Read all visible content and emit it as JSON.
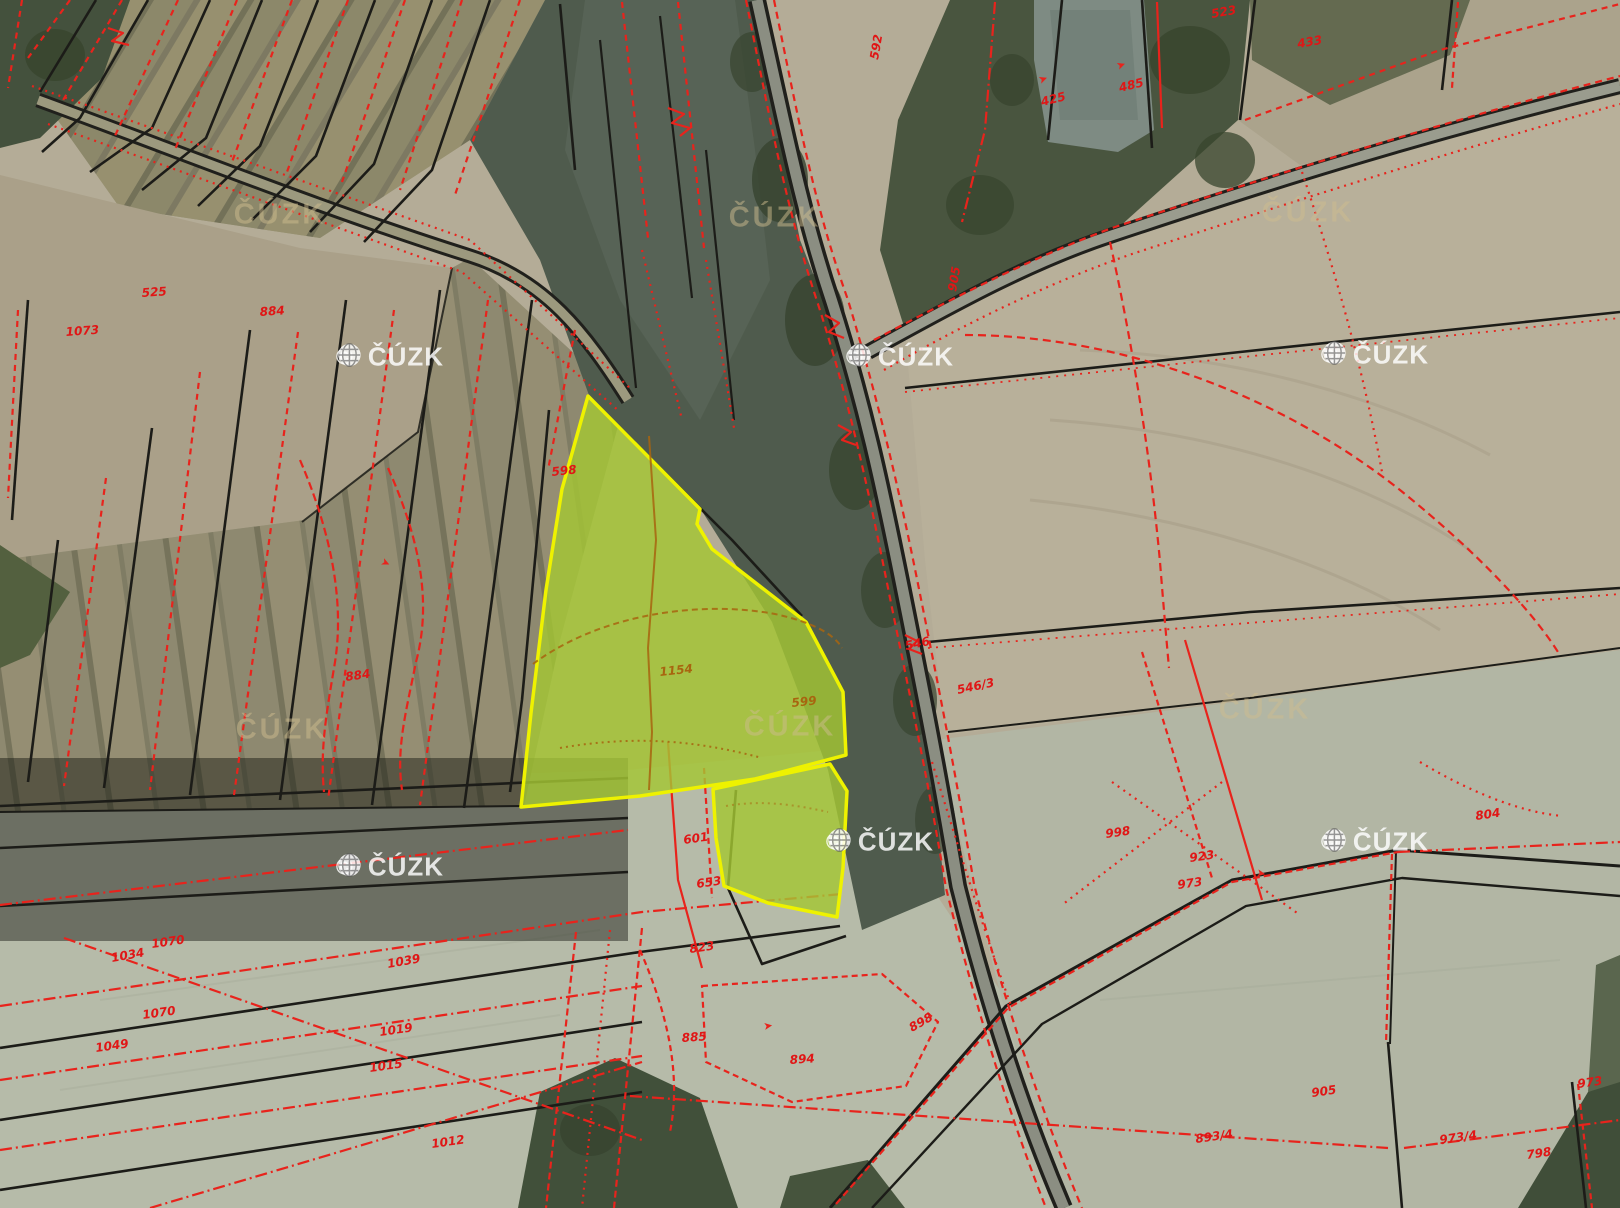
{
  "watermarks": {
    "copyright_symbol": "©",
    "brand": "ČÚZK",
    "logo_items": [
      {
        "x": 390,
        "y": 357
      },
      {
        "x": 900,
        "y": 357
      },
      {
        "x": 1375,
        "y": 355
      },
      {
        "x": 390,
        "y": 867
      },
      {
        "x": 880,
        "y": 842
      },
      {
        "x": 1375,
        "y": 842
      }
    ],
    "text_items": [
      {
        "x": 280,
        "y": 215
      },
      {
        "x": 775,
        "y": 218
      },
      {
        "x": 1308,
        "y": 213
      },
      {
        "x": 282,
        "y": 730
      },
      {
        "x": 790,
        "y": 727
      },
      {
        "x": 1265,
        "y": 710
      }
    ]
  },
  "colors": {
    "cadastral_line_red": "#e8231c",
    "boundary_line_black": "#1c1c18",
    "highlight_fill": "#a4c633",
    "highlight_stroke": "#eef200",
    "label_red": "#e01616",
    "label_orange": "#a8650f",
    "watermark_white": "rgba(255,255,255,0.82)",
    "watermark_beige": "rgba(205,188,142,0.5)"
  },
  "parcel_labels": [
    {
      "t": "523",
      "x": 1212,
      "y": 18,
      "r": -10
    },
    {
      "t": "433",
      "x": 1298,
      "y": 48,
      "r": -10
    },
    {
      "t": "425",
      "x": 1042,
      "y": 106,
      "r": -14
    },
    {
      "t": "485",
      "x": 1120,
      "y": 92,
      "r": -14
    },
    {
      "t": "592",
      "x": 878,
      "y": 60,
      "r": -80
    },
    {
      "t": "905",
      "x": 956,
      "y": 292,
      "r": -80
    },
    {
      "t": "1073",
      "x": 66,
      "y": 336,
      "r": -4
    },
    {
      "t": "525",
      "x": 142,
      "y": 297,
      "r": -4
    },
    {
      "t": "884",
      "x": 260,
      "y": 316,
      "r": -4
    },
    {
      "t": "884",
      "x": 346,
      "y": 681,
      "r": -8
    },
    {
      "t": "598",
      "x": 552,
      "y": 476,
      "r": -6
    },
    {
      "t": "546",
      "x": 906,
      "y": 650,
      "r": -12
    },
    {
      "t": "546/3",
      "x": 958,
      "y": 694,
      "r": -12
    },
    {
      "t": "804",
      "x": 1476,
      "y": 820,
      "r": -8
    },
    {
      "t": "998",
      "x": 1106,
      "y": 838,
      "r": -8
    },
    {
      "t": "923",
      "x": 1190,
      "y": 862,
      "r": -8
    },
    {
      "t": "973",
      "x": 1178,
      "y": 889,
      "r": -8
    },
    {
      "t": "601",
      "x": 684,
      "y": 844,
      "r": -8
    },
    {
      "t": "653",
      "x": 697,
      "y": 888,
      "r": -8
    },
    {
      "t": "823",
      "x": 690,
      "y": 953,
      "r": -8
    },
    {
      "t": "1070",
      "x": 152,
      "y": 948,
      "r": -8
    },
    {
      "t": "1034",
      "x": 112,
      "y": 962,
      "r": -10
    },
    {
      "t": "1039",
      "x": 388,
      "y": 968,
      "r": -10
    },
    {
      "t": "1070",
      "x": 143,
      "y": 1019,
      "r": -8
    },
    {
      "t": "1049",
      "x": 96,
      "y": 1052,
      "r": -8
    },
    {
      "t": "1019",
      "x": 380,
      "y": 1036,
      "r": -8
    },
    {
      "t": "1015",
      "x": 370,
      "y": 1072,
      "r": -8
    },
    {
      "t": "1012",
      "x": 432,
      "y": 1148,
      "r": -8
    },
    {
      "t": "885",
      "x": 682,
      "y": 1042,
      "r": -4
    },
    {
      "t": "894",
      "x": 790,
      "y": 1064,
      "r": -4
    },
    {
      "t": "898",
      "x": 912,
      "y": 1032,
      "r": -30
    },
    {
      "t": "905",
      "x": 1312,
      "y": 1097,
      "r": -8,
      "s": 14
    },
    {
      "t": "893/4",
      "x": 1196,
      "y": 1143,
      "r": -8,
      "s": 13
    },
    {
      "t": "973/4",
      "x": 1440,
      "y": 1144,
      "r": -8
    },
    {
      "t": "798",
      "x": 1527,
      "y": 1159,
      "r": -8
    },
    {
      "t": "973",
      "x": 1578,
      "y": 1088,
      "r": -8
    },
    {
      "t": "1154",
      "x": 660,
      "y": 676,
      "r": -6,
      "c": "orange"
    },
    {
      "t": "599",
      "x": 792,
      "y": 707,
      "r": -6,
      "c": "orange"
    }
  ],
  "arrow_marks": [
    {
      "x": 1040,
      "y": 84,
      "r": -20
    },
    {
      "x": 1118,
      "y": 70,
      "r": -20
    },
    {
      "x": 764,
      "y": 1030,
      "r": -8
    },
    {
      "x": 1256,
      "y": 876,
      "r": 10
    },
    {
      "x": 380,
      "y": 564,
      "r": 25
    }
  ]
}
